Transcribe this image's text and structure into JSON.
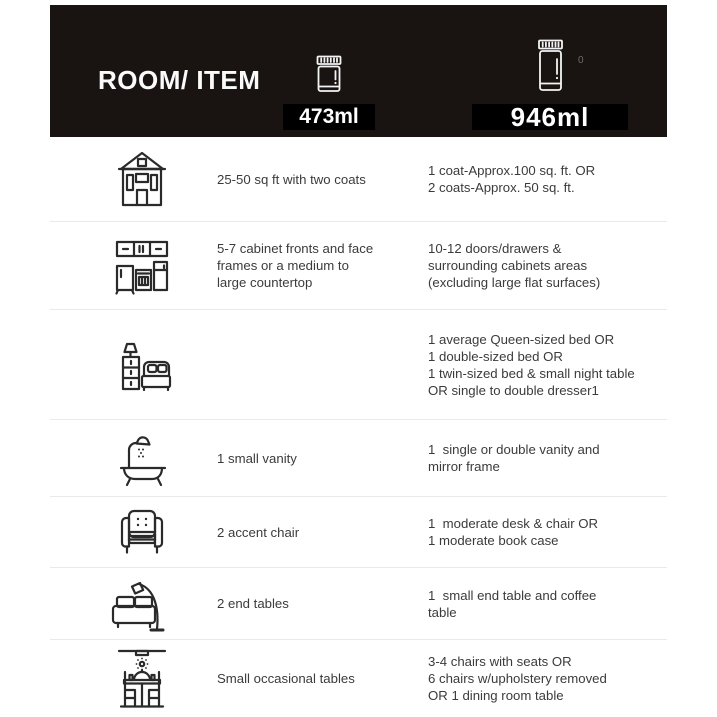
{
  "chart_data": {
    "type": "table",
    "title": "ROOM/ ITEM",
    "columns": [
      "ROOM/ ITEM",
      "473ml",
      "946ml"
    ],
    "rows": [
      [
        "house-icon",
        "25-50 sq ft with two coats",
        "1 coat-Approx.100 sq. ft. OR\n2 coats-Approx. 50 sq. ft."
      ],
      [
        "kitchen-cabinets-icon",
        "5-7 cabinet fronts and face\nframes or a medium to\nlarge countertop",
        "10-12 doors/drawers &\nsurrounding cabinets areas\n(excluding large flat surfaces)"
      ],
      [
        "bedroom-icon",
        "",
        "1 average Queen-sized bed OR\n1 double-sized bed OR\n1 twin-sized bed & small night table\nOR single to double dresser1"
      ],
      [
        "bathtub-icon",
        "1 small vanity",
        "1  single or double vanity and\nmirror frame"
      ],
      [
        "armchair-icon",
        "2 accent chair",
        "1  moderate desk & chair OR\n1 moderate book case"
      ],
      [
        "sofa-floor-lamp-icon",
        "2 end tables",
        "1  small end table and coffee\ntable"
      ],
      [
        "dining-table-icon",
        "Small occasional tables",
        "3-4 chairs with seats OR\n6 chairs w/upholstery removed\nOR 1 dining room table"
      ]
    ],
    "legend_position": "top",
    "grid": "horizontal-dividers"
  },
  "header": {
    "stray_mark": "0"
  },
  "colors": {
    "header_bg": "#191411",
    "label_bg": "#000000",
    "header_text": "#ffffff",
    "body_text": "#3b3b3b",
    "icon_stroke": "#2a2a2a",
    "divider": "#e9e9e9",
    "page_bg": "#ffffff"
  }
}
